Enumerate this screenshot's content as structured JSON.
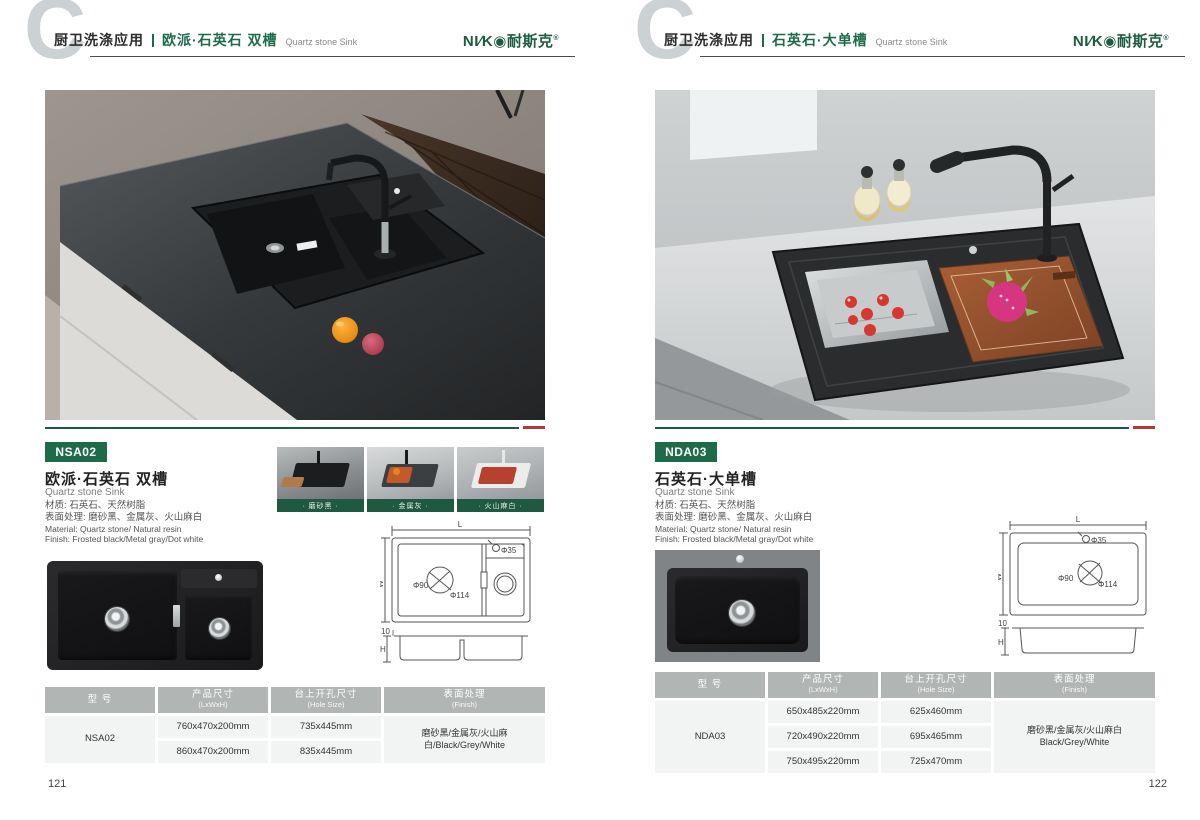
{
  "colors": {
    "accent_green": "#1e6b4a",
    "dark_green_bar": "#1d5a41",
    "accent_red": "#b23a3f",
    "table_header_gray": "#b1b5b4",
    "table_row_gray": "#f2f3f3",
    "logo_green": "#1d5c40"
  },
  "brand": {
    "logo_text": "NI∕K◉耐斯克",
    "logo_reg": "®"
  },
  "left": {
    "page_number": "121",
    "watermark": "C",
    "header": {
      "category": "厨卫洗涤应用",
      "title": "欧派·石英石 双槽",
      "subtitle": "Quartz stone Sink"
    },
    "product": {
      "model": "NSA02",
      "title": "欧派·石英石 双槽",
      "subtitle": "Quartz stone Sink",
      "material_cn": "材质: 石英石、天然树脂",
      "finish_cn": "表面处理: 磨砂黑、金属灰、火山麻白",
      "material_en": "Material: Quartz stone/ Natural resin",
      "finish_en": "Finish: Frosted black/Metal gray/Dot white"
    },
    "swatches": [
      {
        "label": "· 磨砂黑 ·"
      },
      {
        "label": "· 金属灰 ·"
      },
      {
        "label": "· 火山麻白 ·"
      }
    ],
    "drawing": {
      "L": "L",
      "W": "W",
      "H": "H",
      "edge": "10",
      "hole": "Φ35",
      "drain_inner": "Φ90",
      "drain_outer": "Φ114"
    },
    "table": {
      "headers": [
        {
          "label": "型 号",
          "sub": ""
        },
        {
          "label": "产品尺寸",
          "sub": "(LxWxH)"
        },
        {
          "label": "台上开孔尺寸",
          "sub": "(Hole Size)"
        },
        {
          "label": "表面处理",
          "sub": "(Finish)"
        }
      ],
      "model": "NSA02",
      "rows": [
        {
          "size": "760x470x200mm",
          "hole": "735x445mm"
        },
        {
          "size": "860x470x200mm",
          "hole": "835x445mm"
        }
      ],
      "finish": "磨砂黑/金属灰/火山麻白/Black/Grey/White"
    }
  },
  "right": {
    "page_number": "122",
    "watermark": "C",
    "header": {
      "category": "厨卫洗涤应用",
      "title": "石英石·大单槽",
      "subtitle": "Quartz stone Sink"
    },
    "product": {
      "model": "NDA03",
      "title": "石英石·大单槽",
      "subtitle": "Quartz stone Sink",
      "material_cn": "材质: 石英石、天然树脂",
      "finish_cn": "表面处理: 磨砂黑、金属灰、火山麻白",
      "material_en": "Material: Quartz stone/ Natural resin",
      "finish_en": "Finish: Frosted black/Metal gray/Dot white"
    },
    "drawing": {
      "L": "L",
      "W": "W",
      "H": "H",
      "edge": "10",
      "hole": "Φ35",
      "drain_inner": "Φ90",
      "drain_outer": "Φ114"
    },
    "table": {
      "headers": [
        {
          "label": "型 号",
          "sub": ""
        },
        {
          "label": "产品尺寸",
          "sub": "(LxWxH)"
        },
        {
          "label": "台上开孔尺寸",
          "sub": "(Hole Size)"
        },
        {
          "label": "表面处理",
          "sub": "(Finish)"
        }
      ],
      "model": "NDA03",
      "rows": [
        {
          "size": "650x485x220mm",
          "hole": "625x460mm"
        },
        {
          "size": "720x490x220mm",
          "hole": "695x465mm"
        },
        {
          "size": "750x495x220mm",
          "hole": "725x470mm"
        }
      ],
      "finish_line1": "磨砂黑/金属灰/火山麻白",
      "finish_line2": "Black/Grey/White"
    }
  }
}
